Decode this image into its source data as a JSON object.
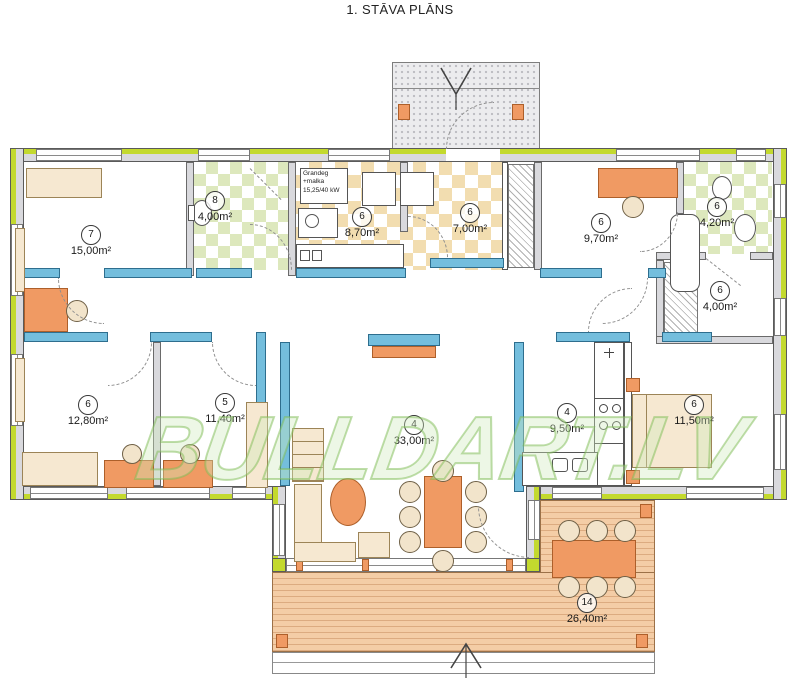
{
  "title": "1. STĀVA PLĀNS",
  "watermark": "BULLDART.LV",
  "boiler_note": [
    "Grandeg",
    "+malka",
    "15,25/40 kW"
  ],
  "rooms": [
    {
      "name": "room-15",
      "number": "7",
      "area": "15,00m²"
    },
    {
      "name": "wc",
      "number": "8",
      "area": "4,00m²"
    },
    {
      "name": "boiler-room",
      "number": "6",
      "area": "8,70m²"
    },
    {
      "name": "hall",
      "number": "6",
      "area": "7,00m²"
    },
    {
      "name": "room-9-70",
      "number": "6",
      "area": "9,70m²"
    },
    {
      "name": "bathroom",
      "number": "6",
      "area": "4,20m²"
    },
    {
      "name": "closet",
      "number": "6",
      "area": "4,00m²"
    },
    {
      "name": "room-12-80",
      "number": "6",
      "area": "12,80m²"
    },
    {
      "name": "room-11-40",
      "number": "5",
      "area": "11,40m²"
    },
    {
      "name": "living-room",
      "number": "4",
      "area": "33,00m²"
    },
    {
      "name": "kitchen",
      "number": "4",
      "area": "9,50m²"
    },
    {
      "name": "bedroom",
      "number": "6",
      "area": "11,50m²"
    },
    {
      "name": "terrace",
      "number": "14",
      "area": "26,40m²"
    }
  ],
  "colors": {
    "insulation_green": "#c3d92e",
    "wall_gray": "#d9d9dd",
    "partition_blue": "#74bedd",
    "furniture_orange": "#f09a63",
    "furniture_beige": "#f6e8d1",
    "floor_tan": "#f2ddb0",
    "floor_green": "#dde8bd",
    "deck_wood": "#f4cda6",
    "watermark_green": "#7ebc54"
  }
}
